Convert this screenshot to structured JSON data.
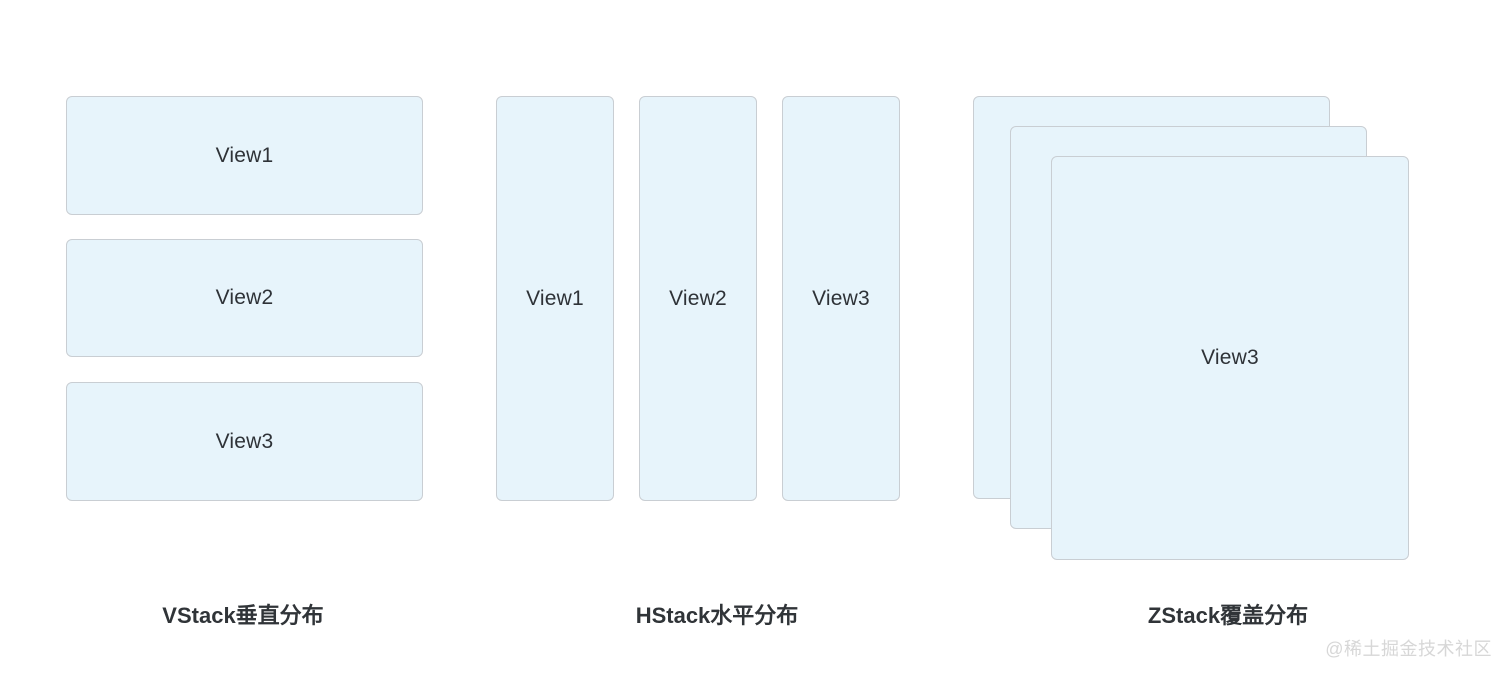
{
  "styles": {
    "box_fill": "#e7f4fb",
    "box_border": "#c9ced3",
    "label_color": "#2e3237",
    "caption_color": "#303438",
    "watermark_color": "#d7d7d7"
  },
  "sections": {
    "vstack": {
      "caption": "VStack垂直分布",
      "boxes": [
        {
          "label": "View1"
        },
        {
          "label": "View2"
        },
        {
          "label": "View3"
        }
      ]
    },
    "hstack": {
      "caption": "HStack水平分布",
      "boxes": [
        {
          "label": "View1"
        },
        {
          "label": "View2"
        },
        {
          "label": "View3"
        }
      ]
    },
    "zstack": {
      "caption": "ZStack覆盖分布",
      "front_box": {
        "label": "View3"
      }
    }
  },
  "watermark": "@稀土掘金技术社区"
}
